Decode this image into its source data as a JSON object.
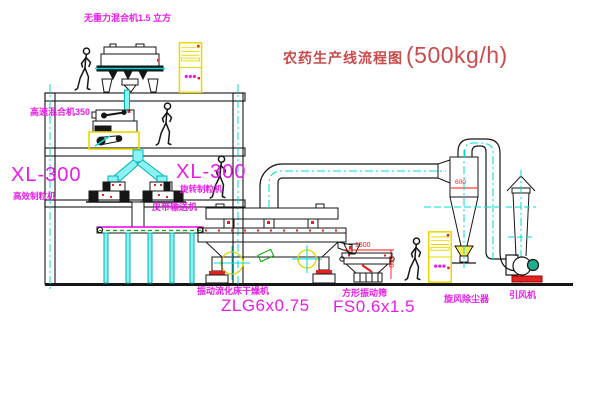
{
  "title": {
    "text": "农药生产线流程图",
    "capacity": "(500kg/h)"
  },
  "labels": {
    "gravity_mixer": "无重力混合机1.5 立方",
    "high_speed_mixer": "高速混合机350",
    "granulator_left_model": "XL-300",
    "granulator_left_name": "高效制粒机",
    "granulator_right_model": "XL-300",
    "granulator_right_name": "旋转制粒机",
    "belt_conveyor": "皮带输送机",
    "dryer_name": "振动流化床干燥机",
    "dryer_model": "ZLG6x0.75",
    "sieve_name": "方形振动筛",
    "sieve_model": "FS0.6x1.5",
    "cyclone": "旋风除尘器",
    "fan": "引风机"
  },
  "dimensions": {
    "sieve_length": "1500",
    "sieve_height": "500",
    "cyclone_diameter": "600"
  },
  "colors": {
    "label_magenta": "#e81ce8",
    "title_red": "#c94b4b",
    "dimension_red": "#ff1111",
    "centerline_cyan": "#00d8d8",
    "cabinet_yellow": "#ead900",
    "conveyor_green": "#00a800"
  }
}
